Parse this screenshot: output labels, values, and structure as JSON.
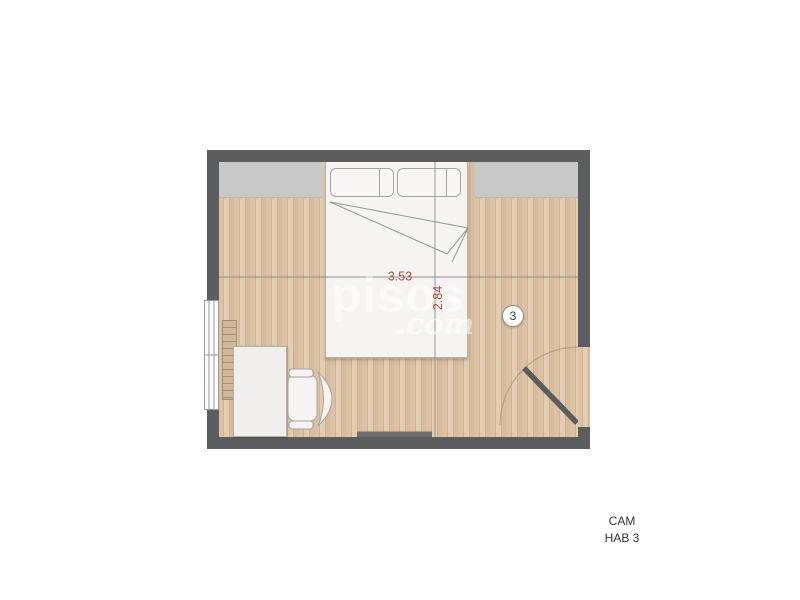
{
  "plan": {
    "labels": {
      "width_dim": "3.53",
      "height_dim": "2.84",
      "room_number": "3"
    },
    "colors": {
      "wall": "#5c5d5e",
      "closet_band": "#c8c8c8",
      "furniture": "#f5f4f2",
      "dim_red": "#b5463c",
      "dim_line": "#8f8f8f"
    }
  },
  "watermark": {
    "word": "pisos",
    "tld": ".com"
  },
  "caption": {
    "line1": "CAM",
    "line2": "HAB 3"
  }
}
